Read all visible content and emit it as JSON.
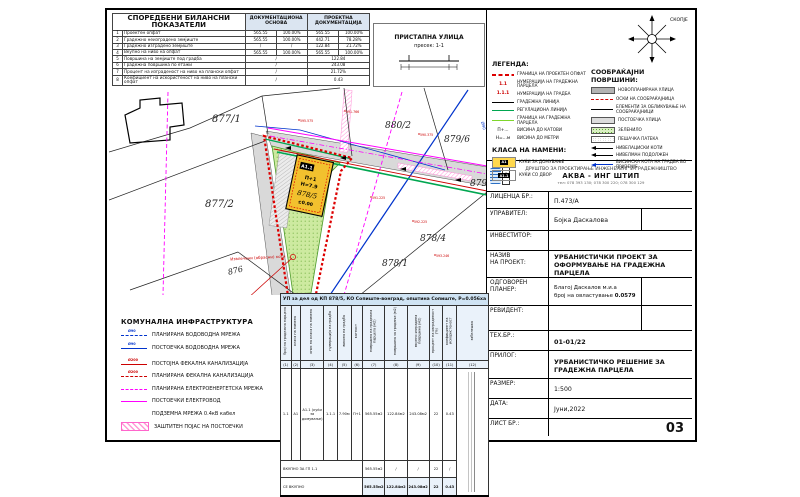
{
  "balance_table": {
    "title": "СПОРЕДБЕНИ БИЛАНСНИ ПОКАЗАТЕЛИ",
    "col_documentation": "ДОКУМЕНТАЦИОНА ОСНОВА",
    "col_project": "ПРОЕКТНА ДОКУМЕНТАЦИЈА",
    "rows": [
      {
        "n": "1",
        "label": "Проектен опфат",
        "d1": "565.55",
        "d2": "100.00%",
        "p1": "565.55",
        "p2": "100.00%"
      },
      {
        "n": "2",
        "label": "Градежно неизградено земјиште",
        "d1": "565.55",
        "d2": "100.00%",
        "p1": "442.71",
        "p2": "78.28%"
      },
      {
        "n": "3",
        "label": "Градежно изградено земјиште",
        "d1": "/",
        "d2": "/",
        "p1": "122.84",
        "p2": "21.72%"
      },
      {
        "n": "4",
        "label": "Вкупно на ниво на опфат",
        "d1": "565.55",
        "d2": "100.00%",
        "p1": "565.55",
        "p2": "100.00%"
      },
      {
        "n": "5",
        "label": "Површина на земјиште под градба",
        "d": "/",
        "p": "122.84"
      },
      {
        "n": "6",
        "label": "Градежна површина по етажи",
        "d": "/",
        "p": "243.08"
      },
      {
        "n": "7",
        "label": "Процент на изграденост на ниво на плански опфат",
        "d": "/",
        "p": "21.72%"
      },
      {
        "n": "8",
        "label": "Коефициент на искористеност на ниво на плански опфат",
        "d": "/",
        "p": "0.43"
      }
    ]
  },
  "street_section": {
    "title": "ПРИСТАПНА УЛИЦА",
    "subtitle": "пресек: 1-1"
  },
  "compass": {
    "city": "СКОПЈЕ"
  },
  "map": {
    "parcels": [
      "877/1",
      "877/2",
      "876",
      "880/2",
      "879/6",
      "879",
      "878/4",
      "878/1"
    ],
    "building": {
      "class": "А1.1",
      "floors": "П+1",
      "height": "Н=7.9",
      "parcel": "878/5",
      "level": "±0.00"
    },
    "elevations": [
      "595.575",
      "591.766",
      "590.375",
      "591.225",
      "592.225",
      "593.246"
    ],
    "note": "Извлечени (обрасни) коти",
    "pipe_label": "Ø90"
  },
  "legend": {
    "title": "ЛЕГЕНДА:",
    "items": [
      {
        "label": "ГРАНИЦА НА ПРОЕКТЕН ОПФАТ"
      },
      {
        "mark": "1.1",
        "label": "НУМЕРАЦИЈА НА ГРАДЕЖНА ПАРЦЕЛА"
      },
      {
        "mark": "1.1.1",
        "label": "НУМЕРАЦИЈА НА ГРАДБА"
      },
      {
        "label": "ГРАДЕЖНА ЛИНИЈА"
      },
      {
        "label": "РЕГУЛАЦИОНА ЛИНИЈА"
      },
      {
        "label": "ГРАНИЦА НА ГРАДЕЖНА ПАРЦЕЛА"
      },
      {
        "mark": "П+...",
        "label": "ВИСИНА ДО КАТОВИ"
      },
      {
        "mark": "Н=...м",
        "label": "ВИСИНА ДО МЕТРИ"
      }
    ],
    "class_title": "КЛАСА НА НАМЕНИ:",
    "classes": [
      {
        "code": "А1",
        "label": "КУЌИ ЗА ДОМУВАЊЕ"
      },
      {
        "code": "А1.1",
        "label": "КУЌИ СО ДВОР"
      }
    ]
  },
  "traffic": {
    "title": "СООБРАЌАЈНИ ПОВРШИНИ:",
    "items": [
      {
        "label": "НОВОПЛАНИРАНА УЛИЦА"
      },
      {
        "label": "ОСКИ НА СООБРАЌАЈНИЦА"
      },
      {
        "label": "ЕЛЕМЕНТИ ЗА ОБЛИКУВАЊЕ НА СООБРАЌАЈНИЦИ"
      },
      {
        "label": "ПОСТОЕЧКА УЛИЦА"
      },
      {
        "label": "ЗЕЛЕНИЛО"
      },
      {
        "label": "ПЕШАЧКА ПАТЕКА"
      },
      {
        "label": "НИВЕЛАЦИСКИ КОТИ"
      },
      {
        "label": "НИВЕЛМАН ПОДОЛЖЕН"
      },
      {
        "label": "ВИСИНСКА КОТА НА ГРАДБА ВО ПРИЗЕМЈЕ"
      }
    ]
  },
  "infrastructure": {
    "title": "КОМУНАЛНА ИНФРАСТРУКТУРА",
    "items": [
      {
        "tag": "Ø90",
        "label": "ПЛАНИРАНА ВОДОВОДНА МРЕЖА"
      },
      {
        "tag": "Ø90",
        "label": "ПОСТОЕЧКА ВОДОВОДНА МРЕЖА"
      },
      {
        "tag": "Ø200",
        "label": "ПОСТОЈНА ФЕКАЛНА КАНАЛИЗАЦИЈА"
      },
      {
        "tag": "Ø200",
        "label": "ПЛАНИРАНА ФЕКАЛНА КАНАЛИЗАЦИЈА"
      },
      {
        "label": "ПЛАНИРАНА ЕЛЕКТРОЕНЕРГЕТСКА МРЕЖА"
      },
      {
        "label": "ПОСТОЕЧКИ ЕЛЕКТРОВОД"
      },
      {
        "label": "ПОДЗЕМНА МРЕЖА   0.4кВ кабел"
      },
      {
        "label": "ЗАШТИТЕН ПОЈАС НА ПОСТОЕЧКИ"
      }
    ]
  },
  "structure_table": {
    "header": "УП за дел од КП 878/5,  КО Сопиште-вонград,  општина Сопиште,  Р=0.056ха",
    "columns": [
      "број на градежна парцела",
      "класа на намена",
      "опис на класа на намена",
      "нумерација на градба",
      "висина на градба",
      "катност",
      "површина на градежна парцела (м2)",
      "површина за градење (м2)",
      "вкупно изградена површина (м2)",
      "процент на изграденост (%)",
      "коефициент на искористеност",
      "забелешка"
    ],
    "indices": [
      "(1)",
      "(2)",
      "(3)",
      "(4)",
      "(5)",
      "(6)",
      "(7)",
      "(8)",
      "(9)",
      "(10)",
      "(11)",
      "(12)"
    ],
    "row": [
      "1.1",
      "А1",
      "А1.1 (куќи за домување)",
      "1.1.1",
      "7.90м",
      "П+1",
      "565.55м2",
      "122.84м2",
      "243.08м2",
      "22",
      "0.43"
    ],
    "total1_label": "ВКУПНО ЗА ГП 1.1",
    "total1": [
      "565.55м2",
      "/",
      "/",
      "22",
      "/"
    ],
    "total2_label": "СЕ ВКУПНО",
    "total2": [
      "565.55м2",
      "122.84м2",
      "243.08м2",
      "22",
      "0.43"
    ]
  },
  "company": {
    "line1": "ДРУШТВО ЗА ПРОЕКТИРАЊЕ ИНЖЕНЕРИНГ И ГРАДЕЖНИШТВО",
    "name": "АКВА - ИНГ ШТИП",
    "phone": "тел: 078 393 130;  078 300 220;  078 300 129"
  },
  "titleblock": {
    "licenca_label": "ЛИЦЕНЦА БР.:",
    "licenca": "П.473/А",
    "upravitel_label": "УПРАВИТЕЛ:",
    "upravitel": "Бојка Даскалова",
    "investitor_label": "ИНВЕСТИТОР:",
    "investitor": "",
    "naziv_label1": "НАЗИВ",
    "naziv_label2": "НА ПРОЕКТ:",
    "naziv": "УРБАНИСТИЧКИ ПРОЕКТ ЗА ОФОРМУВАЊЕ НА ГРАДЕЖНА ПАРЦЕЛА",
    "planer_label1": "ОДГОВОРЕН",
    "planer_label2": "ПЛАНЕР:",
    "planer_name": "Благој Даскалов м.и.а",
    "planer_auth": "број на овластување",
    "planer_auth_no": "0.0579",
    "revident_label": "РЕВИДЕНТ:",
    "revident": "",
    "teh_label": "ТЕХ.БР.:",
    "teh": "01-01/22",
    "prilog_label": "ПРИЛОГ:",
    "prilog": "УРБАНИСТИЧКО РЕШЕНИЕ ЗА ГРАДЕЖНА ПАРЦЕЛА",
    "razmer_label": "РАЗМЕР:",
    "razmer": "1:500",
    "data_label": "ДАТА:",
    "data": "Јуни,2022",
    "list_label": "ЛИСТ БР.:",
    "list": "03"
  }
}
